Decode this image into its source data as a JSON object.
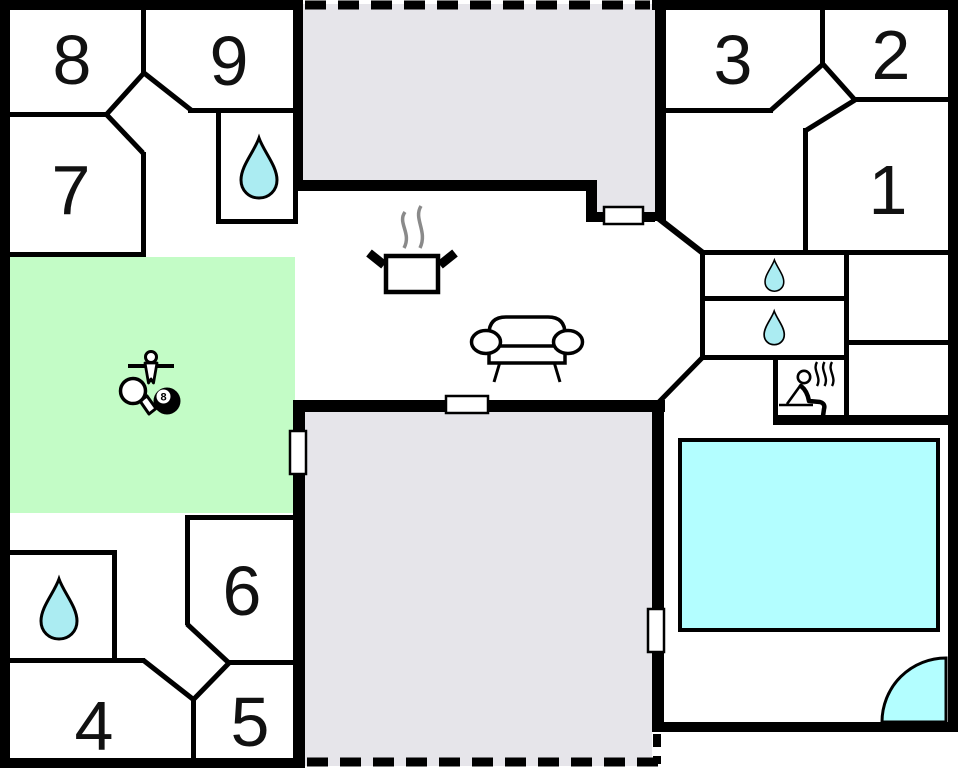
{
  "title": "Holiday home floor plan",
  "rooms": [
    {
      "number": "1"
    },
    {
      "number": "2"
    },
    {
      "number": "3"
    },
    {
      "number": "4"
    },
    {
      "number": "5"
    },
    {
      "number": "6"
    },
    {
      "number": "7"
    },
    {
      "number": "8"
    },
    {
      "number": "9"
    }
  ],
  "billiard_ball": {
    "label": "8"
  },
  "icons": [
    "water-drop-icon",
    "stove-pot-icon",
    "steam-icon",
    "sofa-icon",
    "foosball-player-icon",
    "table-tennis-paddle-icon",
    "billiards-eight-ball-icon",
    "sauna-person-icon",
    "door-opening",
    "entrance-door-arc"
  ],
  "colors": {
    "wall": "#000000",
    "terrace_floor": "#e6e5ea",
    "game_room_floor": "#c3fcc6",
    "pool_water": "#b3feff",
    "water_drop": "#abecf2",
    "steam_gray": "#8a8a8a",
    "room_interior": "#ffffff"
  }
}
